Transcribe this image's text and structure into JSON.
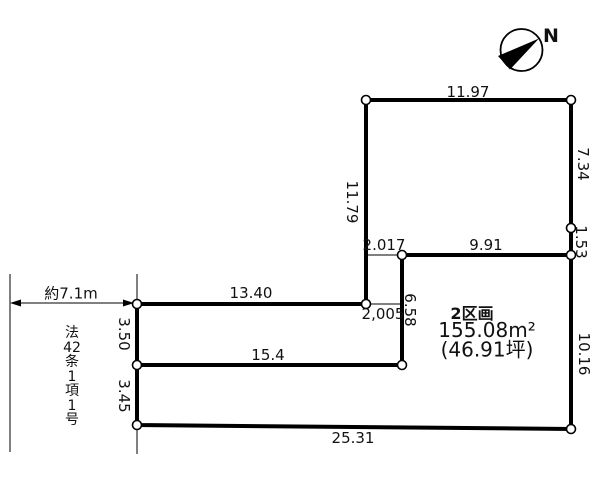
{
  "compass": {
    "north_label": "N"
  },
  "road": {
    "width_label": "約7.1m",
    "law_text": "法\n42\n条\n1\n項\n1\n号"
  },
  "parcel": {
    "name": "2区画",
    "area_sqm": "155.08m²",
    "area_tsubo": "(46.91坪)"
  },
  "dimensions": {
    "top_edge": "11.97",
    "right_upper": "7.34",
    "right_step": "1.53",
    "right_lower": "10.16",
    "inner_left_vertical": "11.79",
    "offset_upper": "2.017",
    "offset_lower": "2,005",
    "inner_horizontal": "9.91",
    "inner_vertical": "6.58",
    "mid_horizontal": "13.40",
    "lower_horizontal": "15.4",
    "left_upper": "3.50",
    "left_lower": "3.45",
    "bottom_edge": "25.31"
  },
  "colors": {
    "line": "#000000",
    "text": "#111111",
    "background": "#ffffff"
  }
}
